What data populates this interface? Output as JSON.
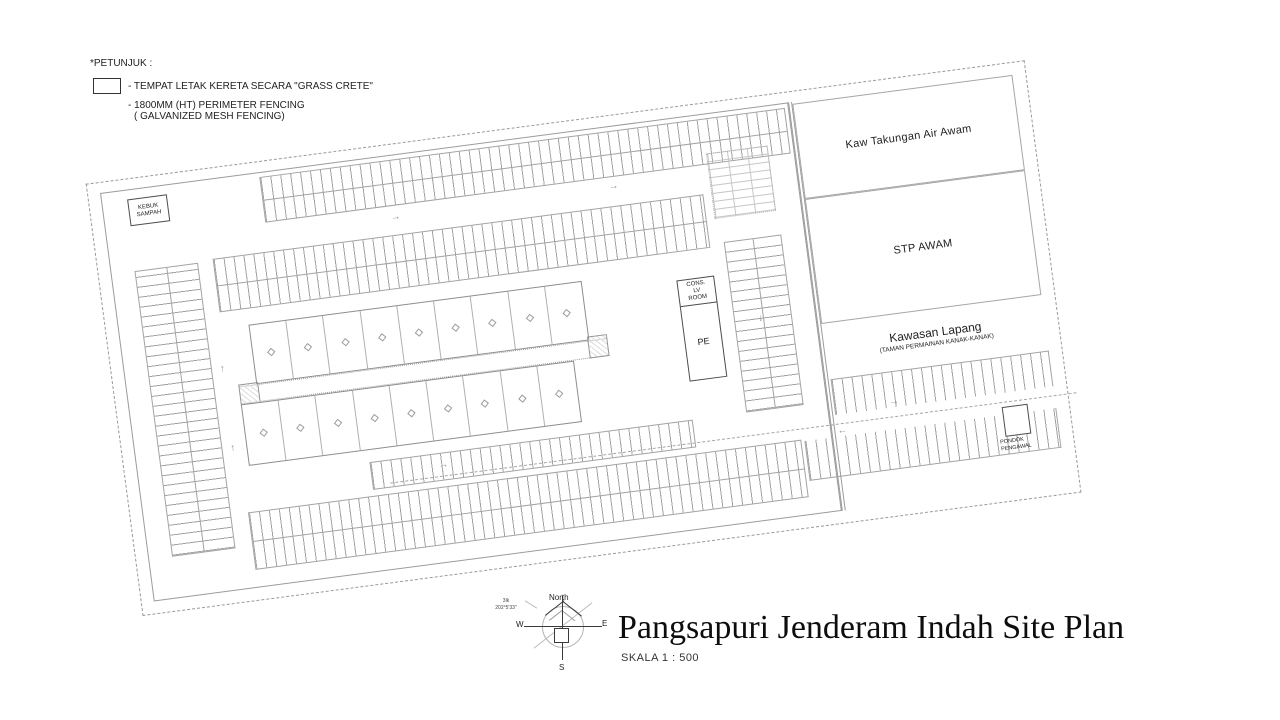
{
  "colors": {
    "background": "#ffffff",
    "drawing_line": "#a3a3a3",
    "dark_line": "#3a3a3a",
    "text": "#1c1c1c"
  },
  "legend": {
    "title": "*PETUNJUK :",
    "grass_crete_label": "- TEMPAT LETAK KERETA SECARA \"GRASS CRETE\"",
    "fencing_label_line1": "- 1800MM (HT) PERIMETER FENCING",
    "fencing_label_line2": "( GALVANIZED MESH FENCING)"
  },
  "plan": {
    "kebuk_sampah_line1": "KEBUK",
    "kebuk_sampah_line2": "SAMPAH",
    "cons_room_line1": "CONS.",
    "cons_room_line2": "LV",
    "cons_room_line3": "ROOM",
    "pe_label": "PE",
    "kaw_takungan_label": "Kaw Takungan Air Awam",
    "stp_awam_label": "STP AWAM",
    "kawasan_lapang_label": "Kawasan Lapang",
    "kawasan_lapang_sublabel": "(TAMAN PERMAINAN KANAK-KANAK)",
    "pondok_line1": "PONDOK",
    "pondok_line2": "PENGAWAL"
  },
  "icons": {
    "arrow_up": "↑",
    "arrow_down": "↓",
    "arrow_left": "←",
    "arrow_right": "→"
  },
  "compass": {
    "north": "North",
    "west": "W",
    "east": "E",
    "south": "S",
    "bearing_line1": "3lk",
    "bearing_line2": "202°5'33\""
  },
  "title_block": {
    "title": "Pangsapuri Jenderam Indah Site Plan",
    "scale": "SKALA  1 : 500"
  }
}
